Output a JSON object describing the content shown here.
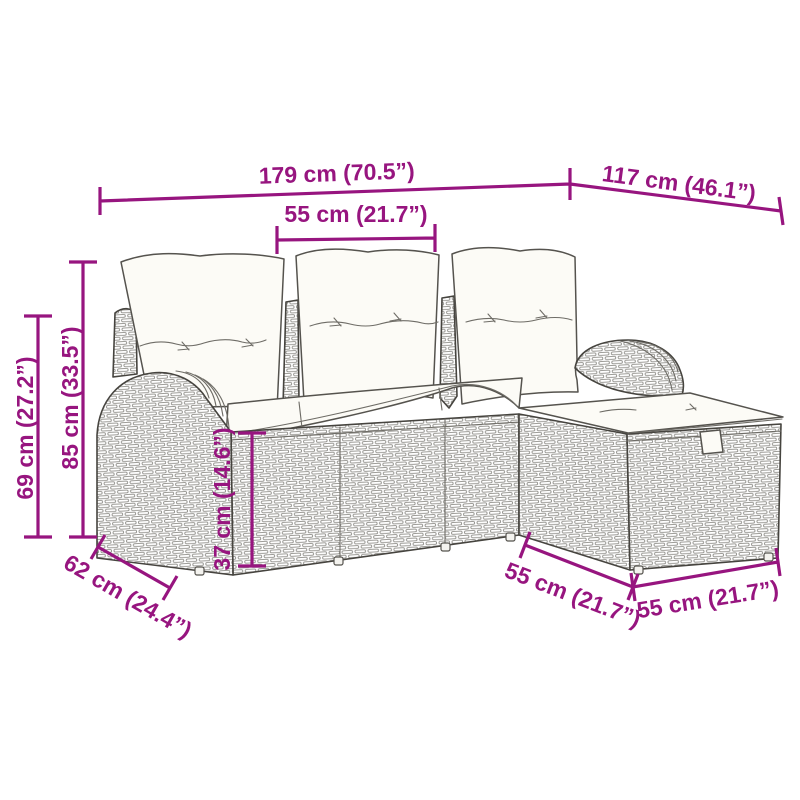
{
  "diagram": {
    "kind": "product-dimension-diagram",
    "subject": "rattan-garden-sofa-set-with-footstool",
    "accent_color": "#97157F",
    "drawing_line_color": "#4C4A46",
    "background_color": "#FFFFFF",
    "labels": {
      "width_total": "179 cm (70.5”)",
      "depth_total": "117 cm (46.1”)",
      "seat_width_top": "55 cm (21.7”)",
      "height_overall": "85 cm (33.5”)",
      "height_armrest": "69 cm (27.2”)",
      "height_seat": "37 cm (14.6”)",
      "depth_side": "62 cm (24.4”)",
      "stool_depth": "55 cm (21.7”)",
      "stool_width": "55 cm (21.7”)"
    }
  }
}
